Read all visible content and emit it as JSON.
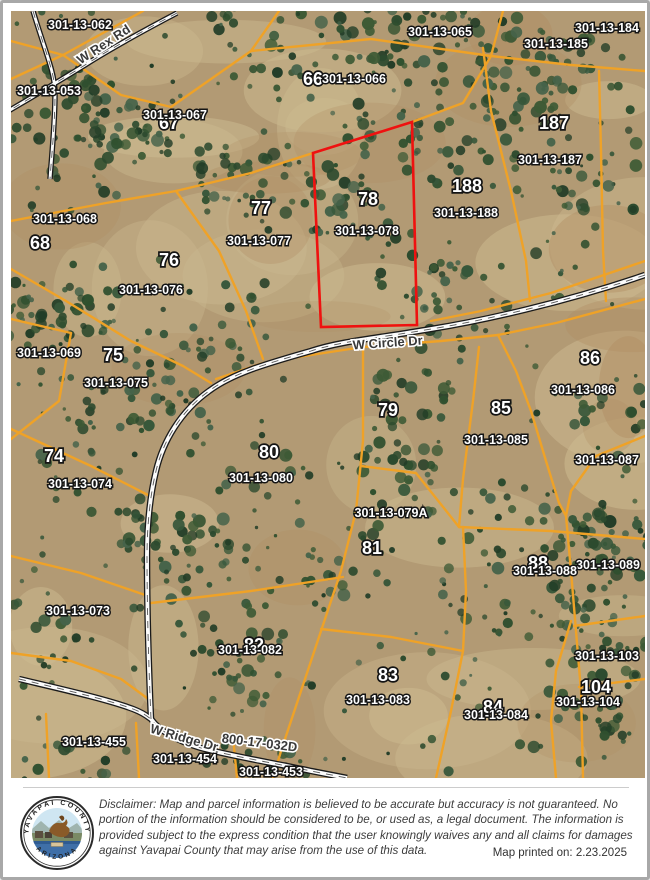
{
  "map": {
    "selected_parcel": {
      "lot": "78",
      "apn": "301-13-078"
    },
    "colors": {
      "parcel_line": "#EFA227",
      "selected_outline": "#EE1111",
      "road_casing": "#1a1a1a",
      "road_fill": "#fbfbfb",
      "road_centerline": "#555555",
      "terrain_base": "#b29a74"
    },
    "road_labels": [
      {
        "text": "W Rex Rd",
        "x": 95,
        "y": 37,
        "angle": -33
      },
      {
        "text": "W Circle Dr",
        "x": 377,
        "y": 336,
        "angle": -4
      },
      {
        "text": "W Ridge Dr",
        "x": 172,
        "y": 731,
        "angle": 16
      },
      {
        "text": "800-17-032D",
        "x": 248,
        "y": 736,
        "angle": 7
      }
    ],
    "lot_labels": [
      {
        "text": "66",
        "x": 302,
        "y": 74
      },
      {
        "text": "67",
        "x": 158,
        "y": 118
      },
      {
        "text": "187",
        "x": 543,
        "y": 118
      },
      {
        "text": "188",
        "x": 456,
        "y": 181
      },
      {
        "text": "78",
        "x": 357,
        "y": 194
      },
      {
        "text": "77",
        "x": 250,
        "y": 203
      },
      {
        "text": "68",
        "x": 29,
        "y": 238
      },
      {
        "text": "76",
        "x": 158,
        "y": 255
      },
      {
        "text": "75",
        "x": 102,
        "y": 350
      },
      {
        "text": "86",
        "x": 579,
        "y": 353
      },
      {
        "text": "85",
        "x": 490,
        "y": 403
      },
      {
        "text": "79",
        "x": 377,
        "y": 405
      },
      {
        "text": "80",
        "x": 258,
        "y": 447
      },
      {
        "text": "74",
        "x": 43,
        "y": 451
      },
      {
        "text": "81",
        "x": 361,
        "y": 543
      },
      {
        "text": "88",
        "x": 527,
        "y": 558
      },
      {
        "text": "82",
        "x": 243,
        "y": 640
      },
      {
        "text": "83",
        "x": 377,
        "y": 670
      },
      {
        "text": "104",
        "x": 585,
        "y": 682
      },
      {
        "text": "84",
        "x": 482,
        "y": 702
      }
    ],
    "apn_labels": [
      {
        "text": "301-13-062",
        "x": 69,
        "y": 18
      },
      {
        "text": "301-13-065",
        "x": 429,
        "y": 25
      },
      {
        "text": "301-13-184",
        "x": 596,
        "y": 21
      },
      {
        "text": "301-13-185",
        "x": 545,
        "y": 37
      },
      {
        "text": "301-13-066",
        "x": 343,
        "y": 72
      },
      {
        "text": "301-13-053",
        "x": 38,
        "y": 84
      },
      {
        "text": "301-13-067",
        "x": 164,
        "y": 108
      },
      {
        "text": "301-13-187",
        "x": 539,
        "y": 153
      },
      {
        "text": "301-13-188",
        "x": 455,
        "y": 206
      },
      {
        "text": "301-13-068",
        "x": 54,
        "y": 212
      },
      {
        "text": "301-13-078",
        "x": 356,
        "y": 224
      },
      {
        "text": "301-13-077",
        "x": 248,
        "y": 234
      },
      {
        "text": "301-13-076",
        "x": 140,
        "y": 283
      },
      {
        "text": "301-13-069",
        "x": 38,
        "y": 346
      },
      {
        "text": "301-13-075",
        "x": 105,
        "y": 376
      },
      {
        "text": "301-13-086",
        "x": 572,
        "y": 383
      },
      {
        "text": "301-13-085",
        "x": 485,
        "y": 433
      },
      {
        "text": "301-13-087",
        "x": 596,
        "y": 453
      },
      {
        "text": "301-13-080",
        "x": 250,
        "y": 471
      },
      {
        "text": "301-13-074",
        "x": 69,
        "y": 477
      },
      {
        "text": "301-13-079A",
        "x": 380,
        "y": 506
      },
      {
        "text": "301-13-089",
        "x": 597,
        "y": 558
      },
      {
        "text": "301-13-088",
        "x": 534,
        "y": 564
      },
      {
        "text": "301-13-073",
        "x": 67,
        "y": 604
      },
      {
        "text": "301-13-082",
        "x": 239,
        "y": 643
      },
      {
        "text": "301-13-103",
        "x": 596,
        "y": 649
      },
      {
        "text": "301-13-083",
        "x": 367,
        "y": 693
      },
      {
        "text": "301-13-104",
        "x": 577,
        "y": 695
      },
      {
        "text": "301-13-084",
        "x": 485,
        "y": 708
      },
      {
        "text": "301-13-455",
        "x": 83,
        "y": 735
      },
      {
        "text": "301-13-454",
        "x": 174,
        "y": 752
      },
      {
        "text": "301-13-453",
        "x": 260,
        "y": 765
      }
    ]
  },
  "footer": {
    "seal_top": "YAVAPAI COUNTY",
    "seal_bottom": "ARIZONA",
    "disclaimer": "Disclaimer: Map and parcel information is believed to be accurate but accuracy is not guaranteed. No portion of the information should be considered to be, or used as, a legal document.  The information is provided subject to the express condition that the user knowingly waives any and all claims for damages against Yavapai County that may arise from the use of this data.",
    "printed_label": "Map printed on: 2.23.2025"
  }
}
